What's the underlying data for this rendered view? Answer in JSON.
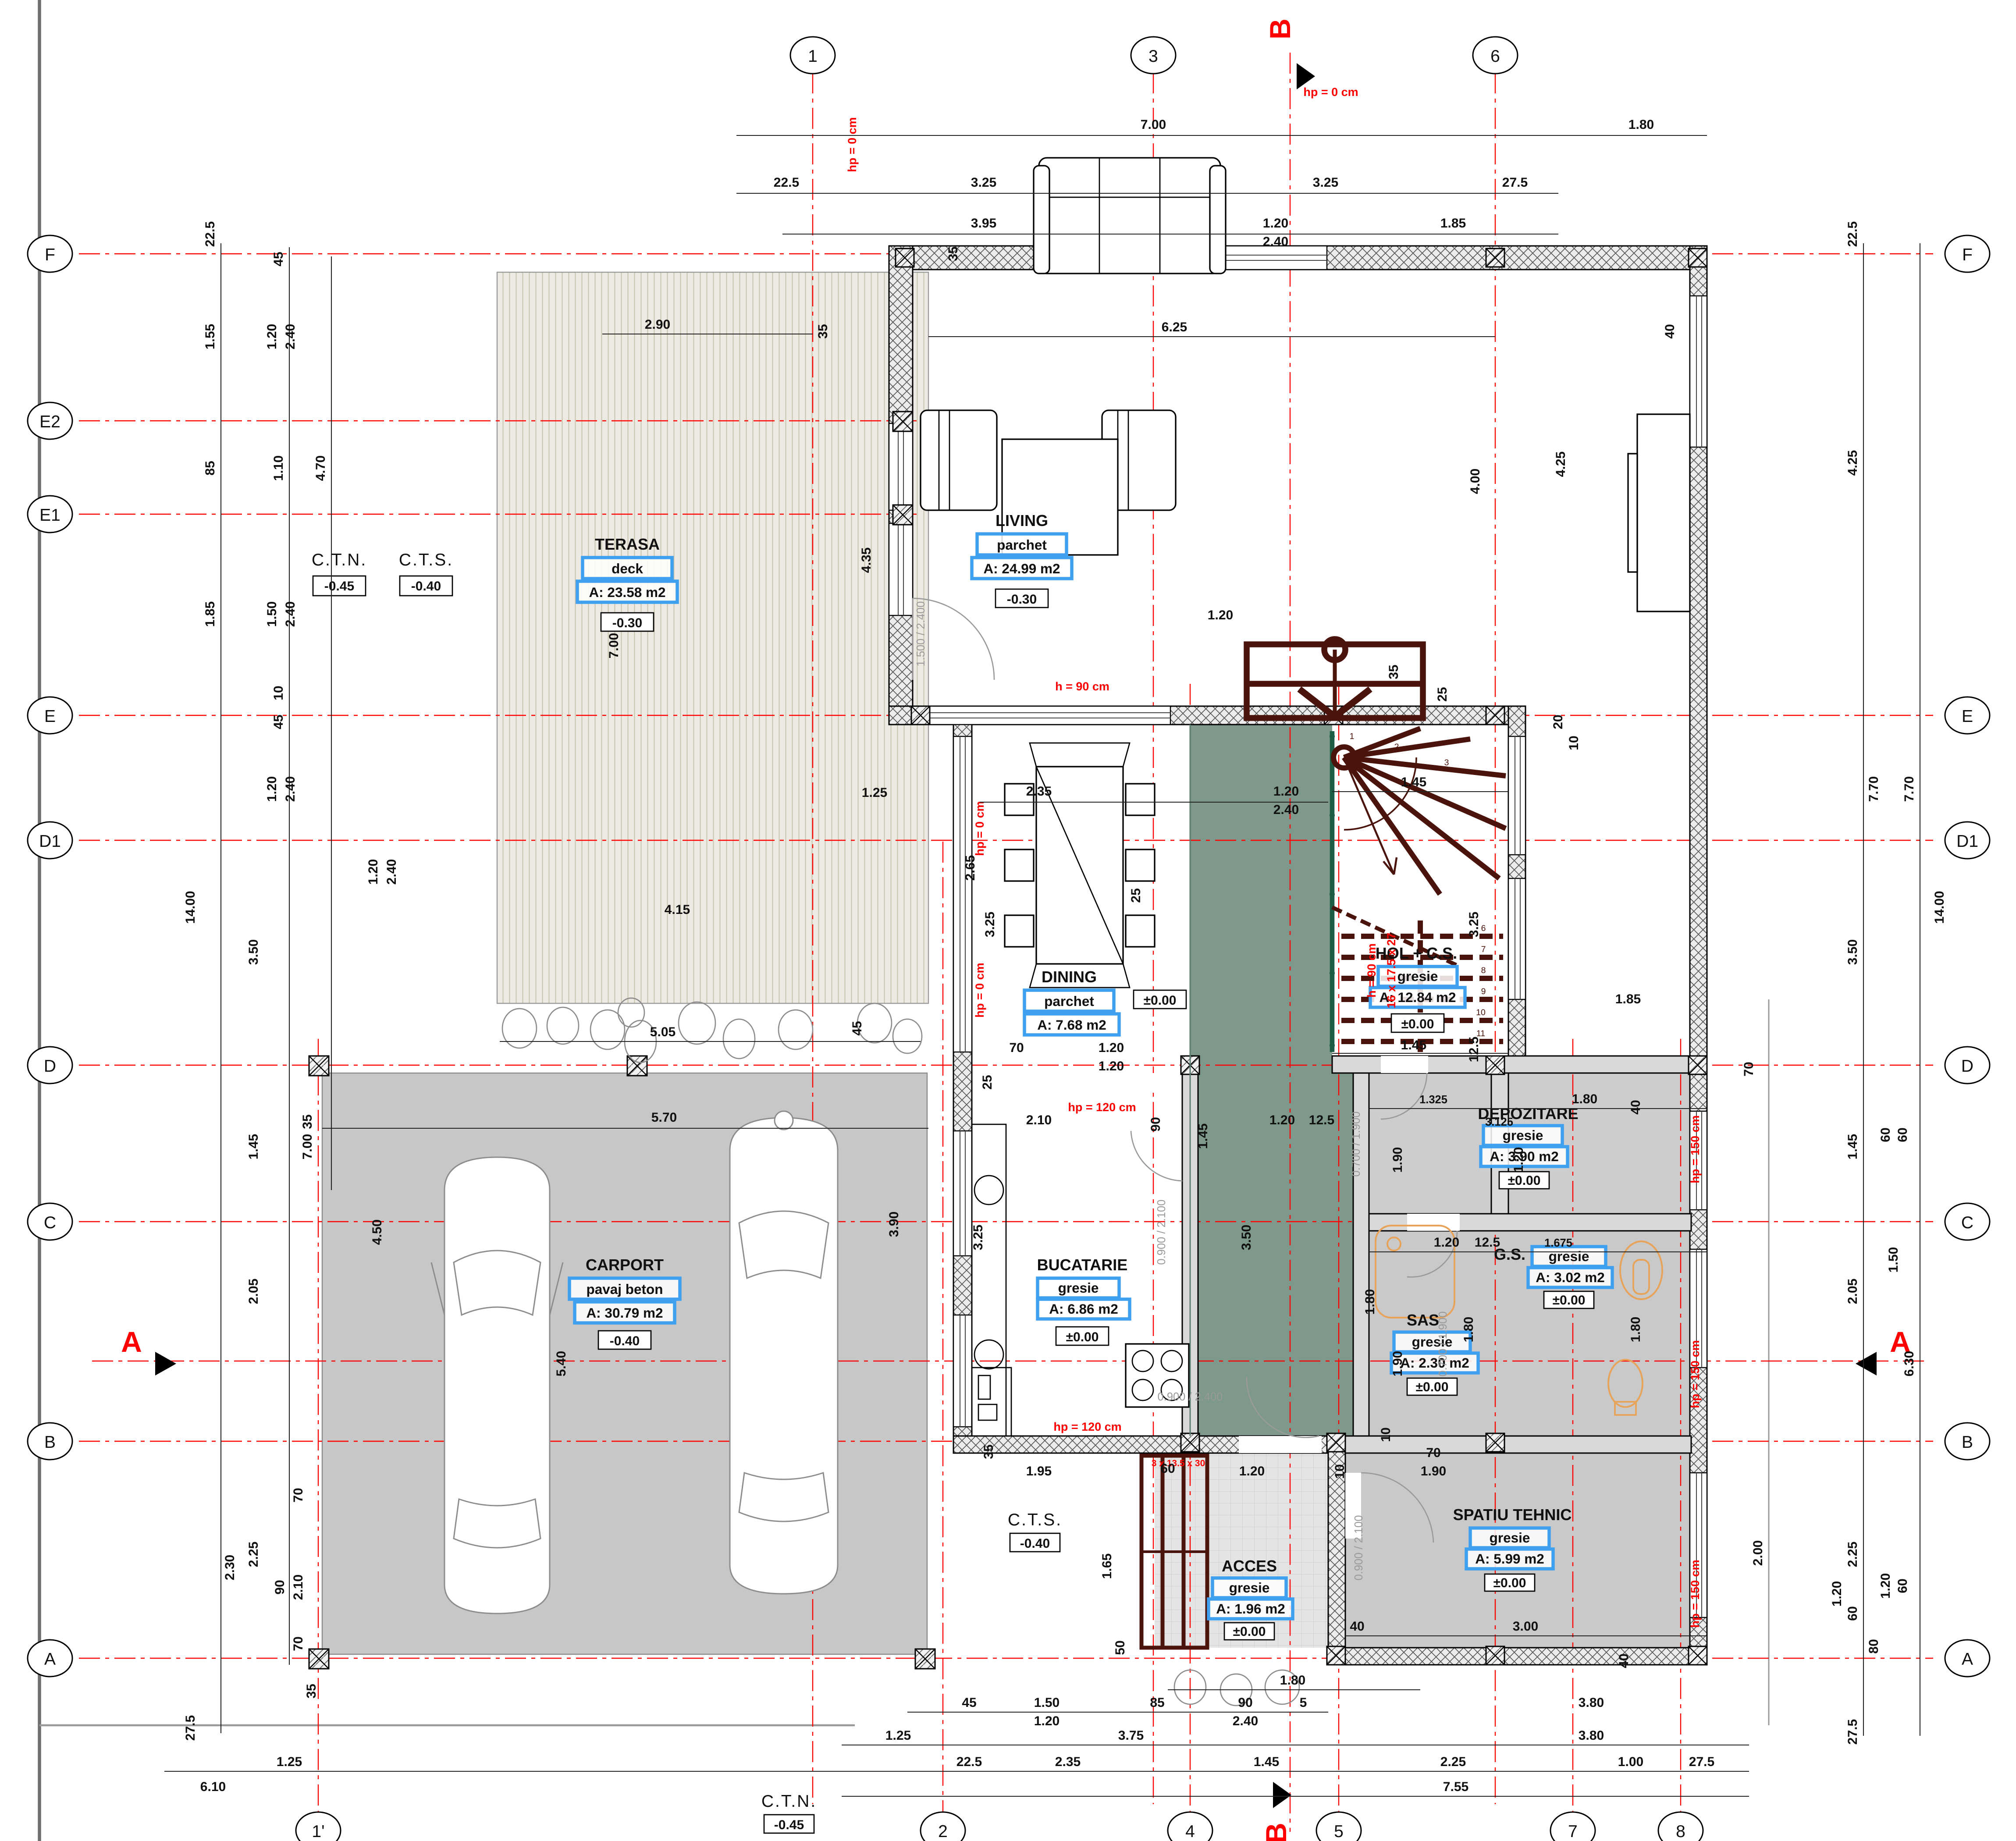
{
  "plan_title": "Ground floor plan",
  "rooms": [
    {
      "name": "TERASA",
      "finish": "deck",
      "area": "A: 23.58 m2",
      "level": "-0.30"
    },
    {
      "name": "LIVING",
      "finish": "parchet",
      "area": "A: 24.99 m2",
      "level": "-0.30"
    },
    {
      "name": "DINING",
      "finish": "parchet",
      "area": "A: 7.68 m2",
      "level": "±0.00"
    },
    {
      "name": "HOL + C.S.",
      "finish": "gresie",
      "area": "A: 12.84 m2",
      "level": "±0.00"
    },
    {
      "name": "BUCATARIE",
      "finish": "gresie",
      "area": "A: 6.86 m2",
      "level": "±0.00"
    },
    {
      "name": "SAS",
      "finish": "gresie",
      "area": "A: 2.30 m2",
      "level": "±0.00"
    },
    {
      "name": "DEPOZITARE",
      "finish": "gresie",
      "area": "A: 3.90 m2",
      "level": "±0.00"
    },
    {
      "name": "G.S.",
      "finish": "gresie",
      "area": "A: 3.02 m2",
      "level": "±0.00"
    },
    {
      "name": "SPATIU TEHNIC",
      "finish": "gresie",
      "area": "A: 5.99 m2",
      "level": "±0.00"
    },
    {
      "name": "ACCES",
      "finish": "gresie",
      "area": "A: 1.96 m2",
      "level": "±0.00"
    },
    {
      "name": "CARPORT",
      "finish": "pavaj beton",
      "area": "A: 30.79 m2",
      "level": "-0.40"
    }
  ],
  "grid": {
    "top": [
      "1",
      "3",
      "6"
    ],
    "bottom": [
      "1'",
      "2",
      "4",
      "5",
      "7",
      "8"
    ],
    "left": [
      "F",
      "E2",
      "E1",
      "E",
      "D1",
      "D",
      "C",
      "B",
      "A"
    ],
    "right": [
      "F",
      "E",
      "D1",
      "D",
      "C",
      "B",
      "A"
    ],
    "section_a": "A",
    "section_b": "B"
  },
  "levels": {
    "ctn": "C.T.N.",
    "ctn_value": "-0.45",
    "cts": "C.T.S.",
    "cts_value": "-0.40"
  },
  "annotations": {
    "hp0": "hp = 0 cm",
    "hp120": "hp = 120 cm",
    "hp150": "hp = 150 cm",
    "h90": "h = 90 cm",
    "stair_formula": "16 x 17.5 x 27",
    "entry_steps": "3 x 13.5 x 30"
  },
  "doors": {
    "terrace": "1.500 / 2.400",
    "hall": "0.900 / 2.400",
    "kitchen": "0.900 / 2.100",
    "sas": "0.700 / 1.900",
    "gs": "0.700 / 1.900",
    "tech": "0.900 / 2.100"
  },
  "stair_numbers": [
    "1",
    "2",
    "3",
    "6",
    "7",
    "8",
    "9",
    "10",
    "11"
  ],
  "dims": {
    "top": [
      "7.00",
      "1.80",
      "22.5",
      "3.25",
      "3.25",
      "27.5",
      "3.95",
      "1.20",
      "2.40",
      "1.85"
    ],
    "left": [
      "22.5",
      "1.55",
      "85",
      "1.85",
      "4.70",
      "45",
      "1.20",
      "2.40",
      "1.10",
      "1.50",
      "2.40",
      "10",
      "45",
      "1.20",
      "2.40",
      "3.50",
      "14.00",
      "1.20",
      "2.40",
      "7.00",
      "1.45",
      "4.50",
      "2.05",
      "5.40",
      "2.25",
      "2.30",
      "70",
      "90",
      "2.10",
      "70",
      "27.5"
    ],
    "right": [
      "22.5",
      "4.25",
      "7.70",
      "7.70",
      "3.50",
      "14.00",
      "1.45",
      "2.05",
      "6.30",
      "2.25",
      "1.20",
      "60",
      "80",
      "27.5"
    ],
    "bottom": [
      "1.80",
      "45",
      "1.50",
      "1.20",
      "85",
      "90",
      "2.40",
      "5",
      "3.80",
      "3.80",
      "1.25",
      "3.75",
      "22.5",
      "2.35",
      "1.45",
      "2.25",
      "1.00",
      "27.5",
      "6.10",
      "7.55",
      "1.25"
    ],
    "inner": [
      "2.90",
      "35",
      "6.25",
      "40",
      "4.25",
      "4.00",
      "4.35",
      "7.00",
      "1.20",
      "35",
      "25",
      "20",
      "10",
      "2.35",
      "1.20",
      "2.40",
      "1.45",
      "1.25",
      "2.65",
      "3.25",
      "25",
      "3.25",
      "1.85",
      "1.45",
      "12.5",
      "4.15",
      "5.05",
      "45",
      "5.70",
      "35",
      "70",
      "1.20",
      "1.20",
      "25",
      "2.10",
      "90",
      "3.90",
      "3.25",
      "3.50",
      "1.45",
      "1.20",
      "12.5",
      "1.325",
      "3.125",
      "1.80",
      "40",
      "1.20",
      "1.90",
      "1.20",
      "12.5",
      "1.675",
      "1.80",
      "1.80",
      "1.80",
      "1.90",
      "10",
      "70",
      "1.90",
      "10",
      "1.95",
      "60",
      "1.20",
      "1.65",
      "3.00",
      "40",
      "40",
      "50",
      "35",
      "2.00",
      "70",
      "60",
      "60",
      "1.50",
      "1.20",
      "60",
      "35",
      "35"
    ]
  },
  "colors": {
    "hall_green": "#7e998c",
    "stair_maroon": "#4a130b",
    "label_blue": "#3fa0f0",
    "axis_red": "#ff0000"
  }
}
